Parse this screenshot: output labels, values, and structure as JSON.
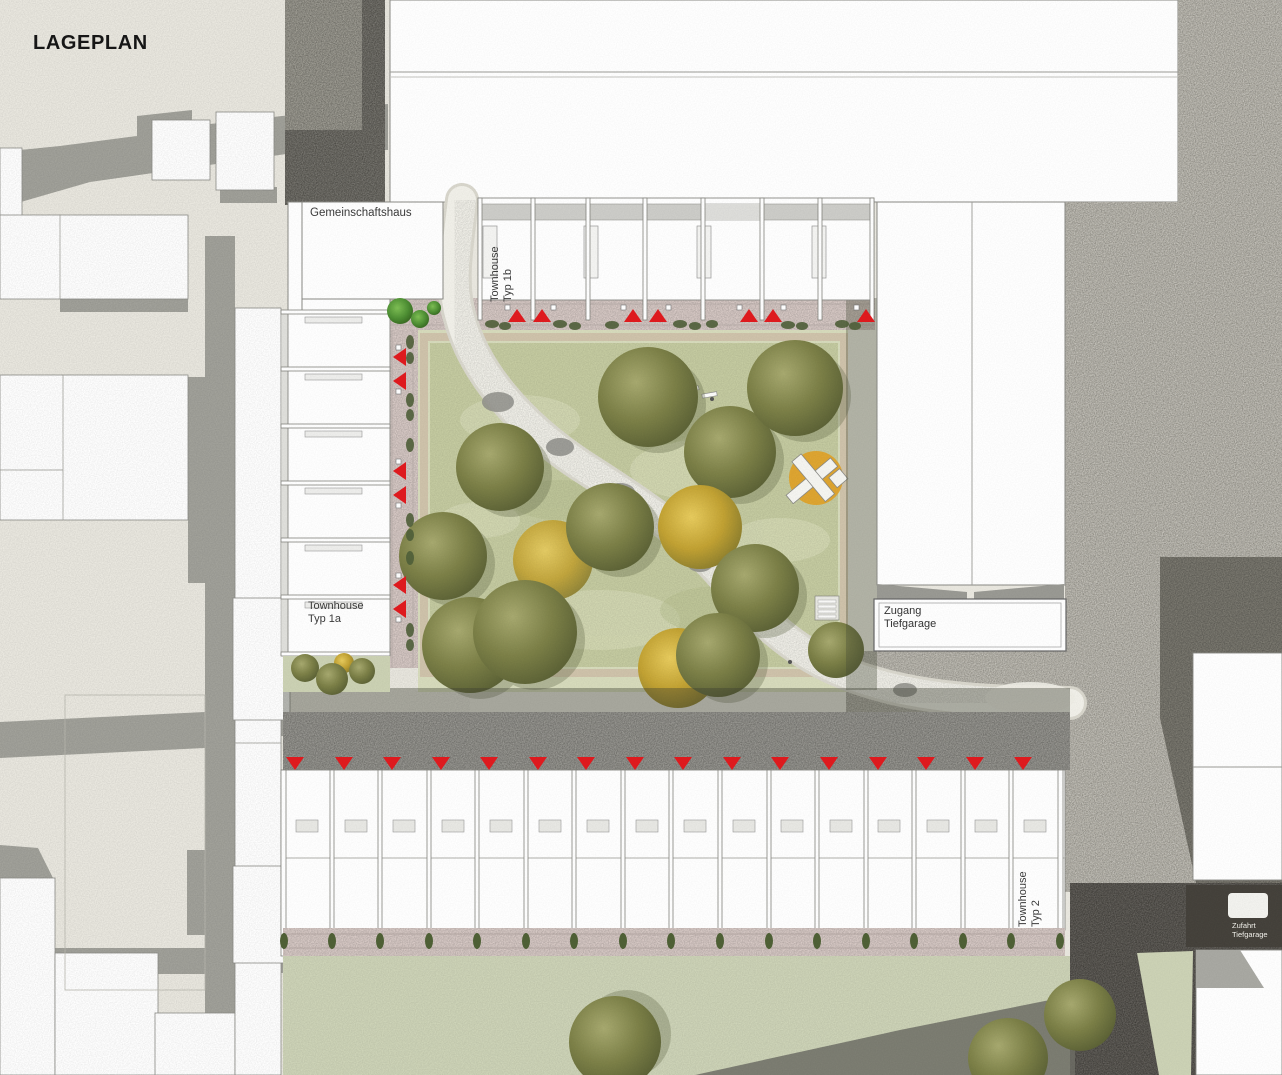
{
  "title": "LAGEPLAN",
  "labels": {
    "community_house": "Gemeinschaftshaus",
    "townhouse_1b": {
      "line1": "Townhouse",
      "line2": "Typ 1b"
    },
    "townhouse_1a": {
      "line1": "Townhouse",
      "line2": "Typ 1a"
    },
    "townhouse_2": {
      "line1": "Townhouse",
      "line2": "Typ 2"
    },
    "garage_access": {
      "line1": "Zugang",
      "line2": "Tiefgarage"
    },
    "garage_ramp": {
      "line1": "Zufahrt",
      "line2": "Tiefgarage"
    }
  },
  "colors": {
    "background": "#eae8e0",
    "entrance_marker_red": "#e11b1f",
    "lawn_green": "#c6cca2",
    "paving_pink": "#d9cbc7",
    "gravel": "#b6b3a9",
    "asphalt": "#595650",
    "street_gray": "#8f8e88",
    "road_gray": "#a2a29b",
    "playground_orange": "#dfa32b",
    "tree_olive": "#7d8148",
    "tree_yellow": "#d2ae3a"
  }
}
